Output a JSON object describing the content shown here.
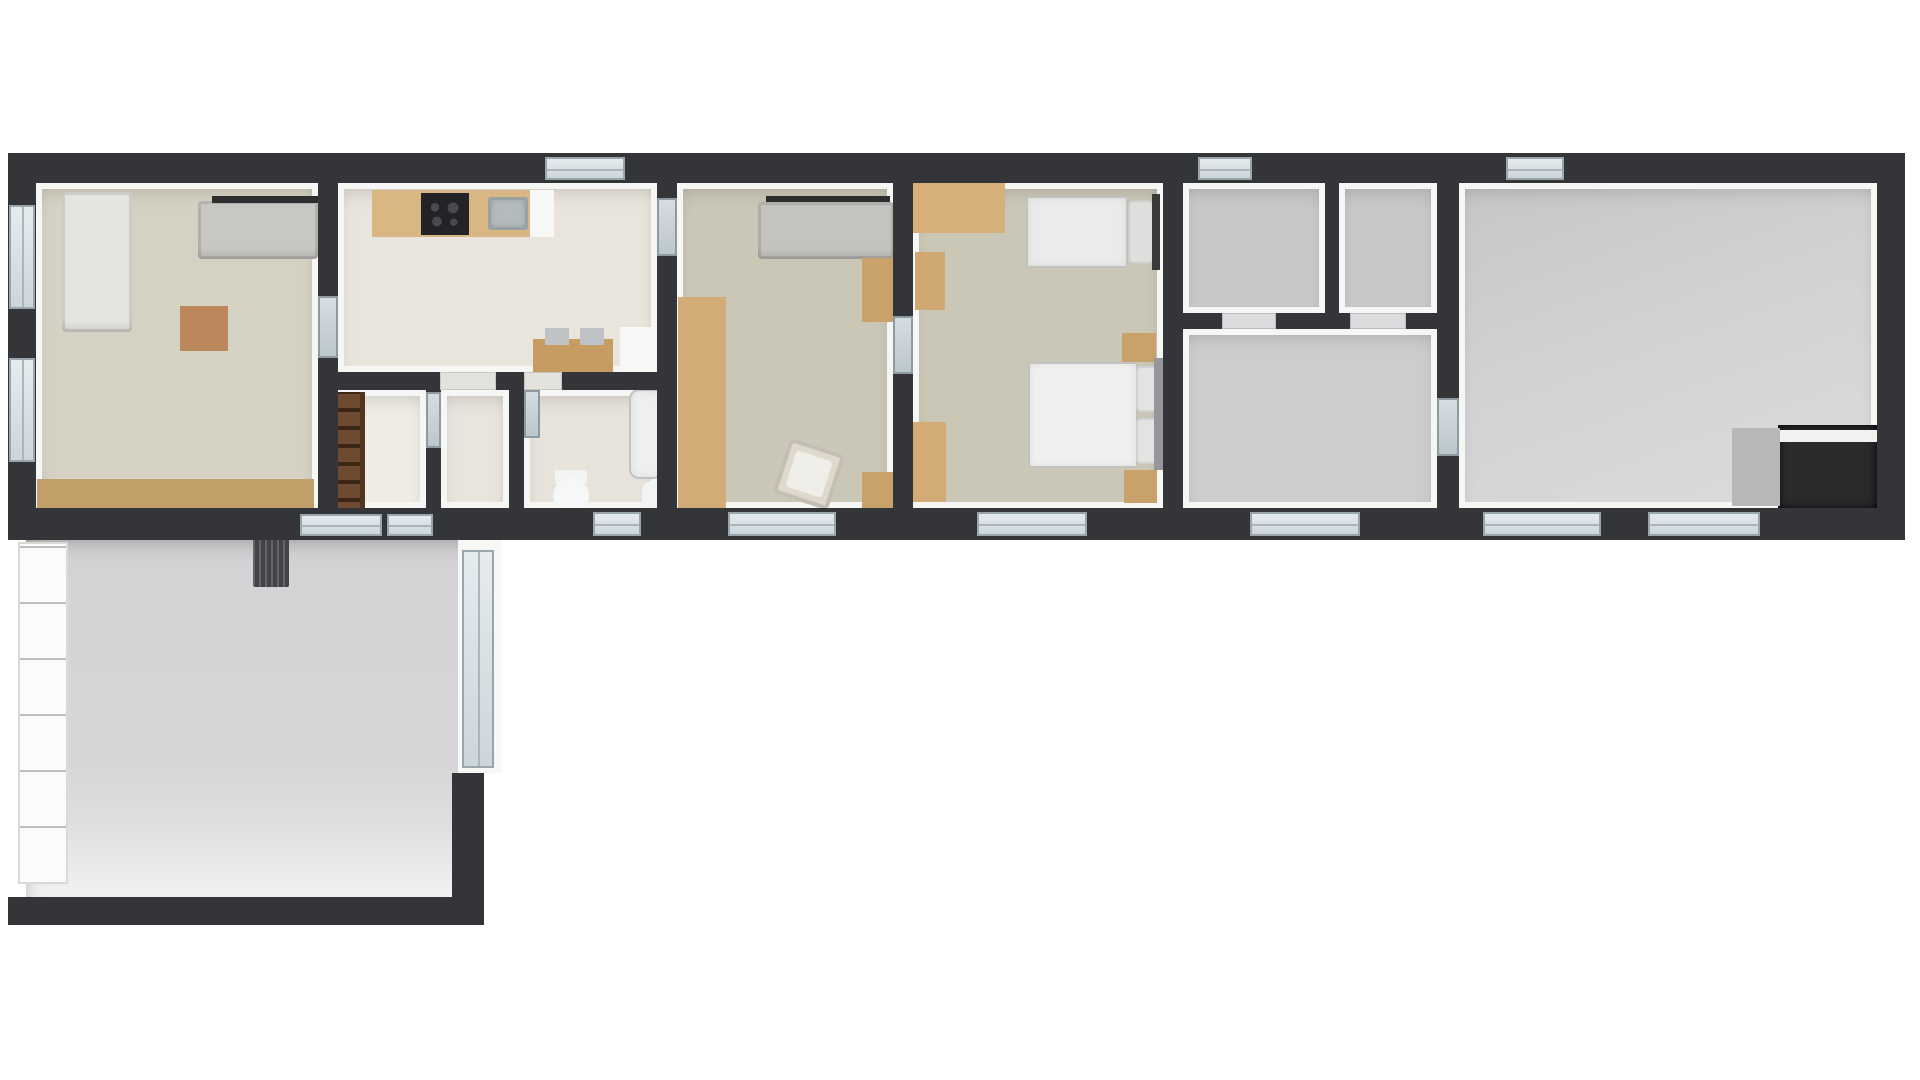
{
  "meta": {
    "description": "Top-down 3D rendered floor plan of a long single-storey house with lower-left annex room",
    "background": "#ffffff"
  },
  "palette": {
    "wall_dark": "#343539",
    "wall_lining": "#f6f6f4",
    "floor_living": "#d6d2c3",
    "floor_tile_kitchen": "#e9e5dc",
    "floor_bedroom": "#cbc7b7",
    "floor_gray": "#c8c8ca",
    "floor_annex": "#d6d6d8",
    "wood_light": "#d6af7a",
    "wood_mid": "#c49a61",
    "wood_dark_ladder": "#6e4b30",
    "sofa_gray": "#c5c3bf",
    "furniture_white": "#f3f3f1",
    "window_frame": "#9aa6ad",
    "window_glass": "#d7dee2"
  },
  "elements": [
    {
      "name": "living-room-floor",
      "cls": "floor",
      "x": 36,
      "y": 183,
      "w": 282,
      "h": 334,
      "bg": "#d6d2c3"
    },
    {
      "name": "kitchen-floor",
      "cls": "floor tile",
      "x": 338,
      "y": 183,
      "w": 319,
      "h": 189,
      "bg": "#e9e5dc"
    },
    {
      "name": "stairs-closet-floor",
      "cls": "floor tile",
      "x": 338,
      "y": 390,
      "w": 88,
      "h": 118,
      "bg": "#efece6"
    },
    {
      "name": "hallway-floor",
      "cls": "floor tile",
      "x": 441,
      "y": 390,
      "w": 68,
      "h": 118,
      "bg": "#e9e5dc"
    },
    {
      "name": "bathroom-floor",
      "cls": "floor tile",
      "x": 524,
      "y": 390,
      "w": 133,
      "h": 118,
      "bg": "#e7e3da"
    },
    {
      "name": "bedroom1-floor",
      "cls": "floor",
      "x": 677,
      "y": 183,
      "w": 216,
      "h": 325,
      "bg": "#cbc7b7"
    },
    {
      "name": "bedroom2-floor",
      "cls": "floor",
      "x": 913,
      "y": 183,
      "w": 250,
      "h": 325,
      "bg": "#cbc7b7"
    },
    {
      "name": "storage-room-a-floor",
      "cls": "floor",
      "x": 1183,
      "y": 183,
      "w": 142,
      "h": 130,
      "bg": "#c8c8ca"
    },
    {
      "name": "storage-room-b-floor",
      "cls": "floor",
      "x": 1339,
      "y": 183,
      "w": 98,
      "h": 130,
      "bg": "#c8c8ca"
    },
    {
      "name": "gray-hall-floor",
      "cls": "floor",
      "x": 1183,
      "y": 329,
      "w": 254,
      "h": 179,
      "bg": "#cdcdcf"
    },
    {
      "name": "big-room-floor",
      "cls": "floor biggray",
      "x": 1459,
      "y": 183,
      "w": 418,
      "h": 325
    },
    {
      "name": "annex-room-floor",
      "cls": "annex",
      "x": 26,
      "y": 540,
      "w": 440,
      "h": 357
    },
    {
      "name": "sofa-chaise-left",
      "cls": "sofa",
      "x": 62,
      "y": 192,
      "w": 70,
      "h": 140,
      "bg": "#e6e4df"
    },
    {
      "name": "sofa-top",
      "cls": "sofa",
      "x": 198,
      "y": 201,
      "w": 120,
      "h": 58,
      "bg": "#c9c7c3"
    },
    {
      "name": "sofa-top-back-bar",
      "cls": "",
      "x": 212,
      "y": 196,
      "w": 106,
      "h": 7,
      "bg": "#2d2d2f"
    },
    {
      "name": "coffee-table",
      "cls": "wood",
      "x": 180,
      "y": 306,
      "w": 48,
      "h": 45,
      "bg": "#b9875b"
    },
    {
      "name": "sideboard-long",
      "cls": "wood",
      "x": 37,
      "y": 479,
      "w": 277,
      "h": 38,
      "bg": "#c29e69"
    },
    {
      "name": "kitchen-counter",
      "cls": "wood",
      "x": 372,
      "y": 190,
      "w": 176,
      "h": 47,
      "bg": "#d8b785"
    },
    {
      "name": "cooktop",
      "cls": "cooktop",
      "x": 421,
      "y": 193,
      "w": 48,
      "h": 42
    },
    {
      "name": "kitchen-sink",
      "cls": "sink",
      "x": 488,
      "y": 197,
      "w": 40,
      "h": 33
    },
    {
      "name": "counter-end-white",
      "cls": "white",
      "x": 530,
      "y": 190,
      "w": 24,
      "h": 47
    },
    {
      "name": "dining-table",
      "cls": "wood",
      "x": 533,
      "y": 339,
      "w": 80,
      "h": 34,
      "bg": "#c79c63"
    },
    {
      "name": "dining-chair-1",
      "cls": "",
      "x": 545,
      "y": 328,
      "w": 24,
      "h": 17,
      "bg": "#c0c3c5"
    },
    {
      "name": "dining-chair-2",
      "cls": "",
      "x": 580,
      "y": 328,
      "w": 24,
      "h": 17,
      "bg": "#c0c3c5"
    },
    {
      "name": "kitchen-appliance",
      "cls": "white",
      "x": 620,
      "y": 327,
      "w": 38,
      "h": 46
    },
    {
      "name": "loft-ladder",
      "cls": "ladder",
      "x": 333,
      "y": 392,
      "w": 32,
      "h": 128
    },
    {
      "name": "bathtub",
      "cls": "bed",
      "x": 629,
      "y": 389,
      "w": 35,
      "h": 90,
      "bg": "#eef0f0",
      "r": "10px"
    },
    {
      "name": "toilet-tank",
      "cls": "",
      "x": 555,
      "y": 470,
      "w": 32,
      "h": 14,
      "bg": "#f2f3f3"
    },
    {
      "name": "toilet-bowl",
      "cls": "round",
      "x": 553,
      "y": 478,
      "w": 36,
      "h": 36,
      "bg": "#f6f7f7"
    },
    {
      "name": "bathroom-sink",
      "cls": "",
      "x": 642,
      "y": 481,
      "w": 23,
      "h": 31,
      "bg": "#f2f3f3",
      "r": "9px"
    },
    {
      "name": "bedroom1-tv-bar",
      "cls": "",
      "x": 766,
      "y": 196,
      "w": 124,
      "h": 6,
      "bg": "#2d2d2f"
    },
    {
      "name": "bedroom1-sofa",
      "cls": "sofa",
      "x": 758,
      "y": 202,
      "w": 136,
      "h": 57,
      "bg": "#c5c3bf"
    },
    {
      "name": "bedroom1-wardrobe",
      "cls": "wood wood-shelf",
      "x": 678,
      "y": 297,
      "w": 48,
      "h": 212,
      "bg": "#d2ab77"
    },
    {
      "name": "bedroom1-cabinet-top",
      "cls": "wood",
      "x": 862,
      "y": 258,
      "w": 31,
      "h": 64,
      "bg": "#c9a26b"
    },
    {
      "name": "bedroom1-armchair",
      "cls": "armchair",
      "x": 780,
      "y": 445,
      "w": 58,
      "h": 58,
      "bg": "#ded9cc",
      "rot": 18
    },
    {
      "name": "bedroom1-cabinet-bottom",
      "cls": "wood",
      "x": 862,
      "y": 472,
      "w": 31,
      "h": 38,
      "bg": "#c9a26b"
    },
    {
      "name": "bedroom2-desk",
      "cls": "wood",
      "x": 913,
      "y": 183,
      "w": 92,
      "h": 50,
      "bg": "#d6af7a"
    },
    {
      "name": "bedroom2-chair",
      "cls": "wood",
      "x": 915,
      "y": 252,
      "w": 30,
      "h": 58,
      "bg": "#cfa873"
    },
    {
      "name": "single-bed-mattress",
      "cls": "bed",
      "x": 1026,
      "y": 196,
      "w": 102,
      "h": 72,
      "bg": "#ebebe9"
    },
    {
      "name": "single-bed-pillow",
      "cls": "pillow",
      "x": 1128,
      "y": 200,
      "w": 26,
      "h": 64,
      "bg": "#dededc"
    },
    {
      "name": "single-bed-headboard",
      "cls": "",
      "x": 1152,
      "y": 194,
      "w": 8,
      "h": 76,
      "bg": "#3a3a3c"
    },
    {
      "name": "bedroom2-cabinet-left",
      "cls": "wood",
      "x": 908,
      "y": 422,
      "w": 38,
      "h": 80,
      "bg": "#d2ab77"
    },
    {
      "name": "nightstand-top",
      "cls": "wood",
      "x": 1122,
      "y": 333,
      "w": 34,
      "h": 29,
      "bg": "#c9a26b"
    },
    {
      "name": "double-bed-mattress",
      "cls": "bed",
      "x": 1028,
      "y": 362,
      "w": 110,
      "h": 106,
      "bg": "#f0f0ee"
    },
    {
      "name": "double-bed-pillow-1",
      "cls": "pillow",
      "x": 1136,
      "y": 366,
      "w": 28,
      "h": 46,
      "bg": "#e3e3e1"
    },
    {
      "name": "double-bed-pillow-2",
      "cls": "pillow",
      "x": 1136,
      "y": 418,
      "w": 28,
      "h": 46,
      "bg": "#e3e3e1"
    },
    {
      "name": "double-bed-headboard",
      "cls": "",
      "x": 1154,
      "y": 358,
      "w": 10,
      "h": 112,
      "bg": "#97979b"
    },
    {
      "name": "nightstand-bottom",
      "cls": "wood",
      "x": 1124,
      "y": 470,
      "w": 33,
      "h": 33,
      "bg": "#c9a26b"
    },
    {
      "name": "big-room-alcove",
      "cls": "alcove",
      "x": 1778,
      "y": 425,
      "w": 99,
      "h": 84
    },
    {
      "name": "big-room-alcove-shelf",
      "cls": "",
      "x": 1778,
      "y": 430,
      "w": 99,
      "h": 12,
      "bg": "#f1f1ef"
    },
    {
      "name": "big-room-gray-box",
      "cls": "",
      "x": 1732,
      "y": 428,
      "w": 48,
      "h": 78,
      "bg": "#b7b7b9"
    },
    {
      "name": "annex-shelving-unit",
      "cls": "shelving",
      "x": 18,
      "y": 542,
      "w": 50,
      "h": 342
    },
    {
      "name": "annex-radiator",
      "cls": "radiator",
      "x": 253,
      "y": 531,
      "w": 36,
      "h": 56
    },
    {
      "name": "outer-wall-top",
      "cls": "wall",
      "x": 8,
      "y": 153,
      "w": 1897,
      "h": 30
    },
    {
      "name": "outer-wall-bottom",
      "cls": "wall",
      "x": 8,
      "y": 508,
      "w": 1897,
      "h": 32
    },
    {
      "name": "outer-wall-left",
      "cls": "wall",
      "x": 8,
      "y": 183,
      "w": 28,
      "h": 325
    },
    {
      "name": "outer-wall-right",
      "cls": "wall",
      "x": 1877,
      "y": 183,
      "w": 28,
      "h": 325
    },
    {
      "name": "wall-living-kitchen",
      "cls": "wall",
      "x": 318,
      "y": 183,
      "w": 20,
      "h": 325
    },
    {
      "name": "wall-kitchen-bedroom1",
      "cls": "wall",
      "x": 657,
      "y": 183,
      "w": 20,
      "h": 325
    },
    {
      "name": "wall-bedroom1-bedroom2",
      "cls": "wall",
      "x": 893,
      "y": 183,
      "w": 20,
      "h": 325
    },
    {
      "name": "wall-bedroom2-storage",
      "cls": "wall",
      "x": 1163,
      "y": 183,
      "w": 20,
      "h": 325
    },
    {
      "name": "wall-storage-bigroom",
      "cls": "wall",
      "x": 1437,
      "y": 183,
      "w": 22,
      "h": 325
    },
    {
      "name": "wall-kitchen-hall",
      "cls": "wall",
      "x": 318,
      "y": 372,
      "w": 359,
      "h": 18
    },
    {
      "name": "wall-storage-hall",
      "cls": "wall",
      "x": 1163,
      "y": 313,
      "w": 296,
      "h": 16
    },
    {
      "name": "wall-storage-a-b",
      "cls": "wall",
      "x": 1325,
      "y": 183,
      "w": 14,
      "h": 130
    },
    {
      "name": "wall-stairs-hallway",
      "cls": "wall",
      "x": 426,
      "y": 390,
      "w": 15,
      "h": 118
    },
    {
      "name": "wall-hallway-bathroom",
      "cls": "wall",
      "x": 509,
      "y": 390,
      "w": 15,
      "h": 118
    },
    {
      "name": "annex-wall-bottom",
      "cls": "wall",
      "x": 8,
      "y": 897,
      "w": 452,
      "h": 28
    },
    {
      "name": "annex-wall-step",
      "cls": "wall",
      "x": 452,
      "y": 773,
      "w": 32,
      "h": 152
    },
    {
      "name": "annex-wall-right-white",
      "cls": "white",
      "x": 458,
      "y": 540,
      "w": 44,
      "h": 233
    },
    {
      "name": "window-living-left-1",
      "cls": "win win-v",
      "x": 9,
      "y": 205,
      "w": 26,
      "h": 104
    },
    {
      "name": "window-living-left-2",
      "cls": "win win-v",
      "x": 9,
      "y": 358,
      "w": 26,
      "h": 104
    },
    {
      "name": "window-kitchen-top",
      "cls": "win win-h",
      "x": 545,
      "y": 157,
      "w": 80,
      "h": 23
    },
    {
      "name": "window-storage-top",
      "cls": "win win-h",
      "x": 1198,
      "y": 157,
      "w": 54,
      "h": 23
    },
    {
      "name": "window-bigroom-top",
      "cls": "win win-h",
      "x": 1506,
      "y": 157,
      "w": 58,
      "h": 23
    },
    {
      "name": "window-bathroom-bottom",
      "cls": "win win-h",
      "x": 593,
      "y": 512,
      "w": 48,
      "h": 24
    },
    {
      "name": "french-window-bedroom1",
      "cls": "win win-h",
      "x": 728,
      "y": 512,
      "w": 108,
      "h": 24
    },
    {
      "name": "french-window-bedroom2",
      "cls": "win win-h",
      "x": 977,
      "y": 512,
      "w": 110,
      "h": 24
    },
    {
      "name": "window-grayhall-bottom",
      "cls": "win win-h",
      "x": 1250,
      "y": 512,
      "w": 110,
      "h": 24
    },
    {
      "name": "window-bigroom-bottom-1",
      "cls": "win win-h",
      "x": 1483,
      "y": 512,
      "w": 118,
      "h": 24
    },
    {
      "name": "window-bigroom-bottom-2",
      "cls": "win win-h",
      "x": 1648,
      "y": 512,
      "w": 112,
      "h": 24
    },
    {
      "name": "window-annex-link-1",
      "cls": "win win-h",
      "x": 300,
      "y": 514,
      "w": 82,
      "h": 22
    },
    {
      "name": "window-annex-link-2",
      "cls": "win win-h",
      "x": 387,
      "y": 514,
      "w": 46,
      "h": 22
    },
    {
      "name": "door-living-kitchen",
      "cls": "door",
      "x": 318,
      "y": 296,
      "w": 20,
      "h": 62
    },
    {
      "name": "door-kitchen-bedroom1",
      "cls": "door",
      "x": 657,
      "y": 198,
      "w": 20,
      "h": 58
    },
    {
      "name": "door-bedroom1-bedroom2",
      "cls": "door",
      "x": 893,
      "y": 316,
      "w": 20,
      "h": 58
    },
    {
      "name": "door-grayhall-bigroom",
      "cls": "door",
      "x": 1437,
      "y": 398,
      "w": 22,
      "h": 58
    },
    {
      "name": "door-stairs-hallway",
      "cls": "door",
      "x": 426,
      "y": 392,
      "w": 15,
      "h": 56
    },
    {
      "name": "threshold-kitchen-hallway",
      "cls": "threshold",
      "x": 440,
      "y": 372,
      "w": 56,
      "h": 18
    },
    {
      "name": "threshold-bathroom",
      "cls": "threshold",
      "x": 524,
      "y": 372,
      "w": 38,
      "h": 18
    },
    {
      "name": "door-leaf-bathroom",
      "cls": "door",
      "x": 524,
      "y": 390,
      "w": 16,
      "h": 48
    },
    {
      "name": "threshold-storage-a",
      "cls": "threshold-gray",
      "x": 1222,
      "y": 313,
      "w": 54,
      "h": 16
    },
    {
      "name": "threshold-storage-b",
      "cls": "threshold-gray",
      "x": 1350,
      "y": 313,
      "w": 56,
      "h": 16
    },
    {
      "name": "annex-glass-door",
      "cls": "win win-v",
      "x": 462,
      "y": 550,
      "w": 32,
      "h": 218
    }
  ]
}
